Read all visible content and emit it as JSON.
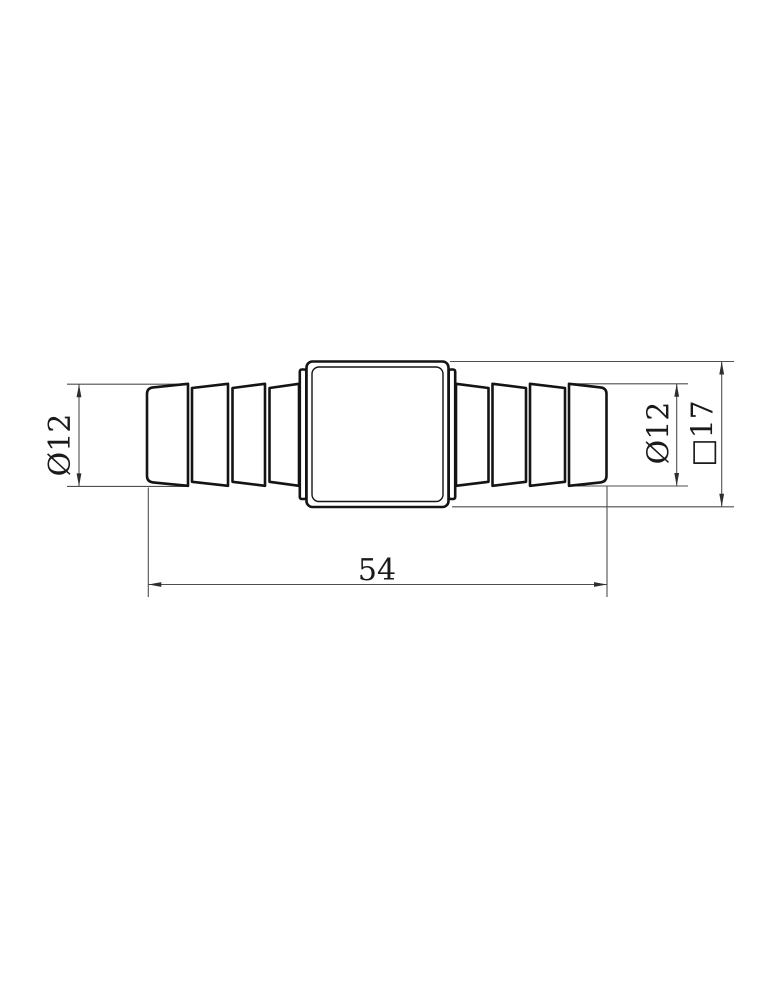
{
  "canvas": {
    "background": "#ffffff",
    "outline_color": "#141414",
    "dimension_line_color": "#4f4f4f",
    "arrow_color": "#2e2e2e",
    "text_color": "#1a1a1a"
  },
  "dimensions": {
    "left_diameter": "Ø12",
    "right_diameter": "Ø12",
    "square_width": "□17",
    "overall_length": "54"
  }
}
